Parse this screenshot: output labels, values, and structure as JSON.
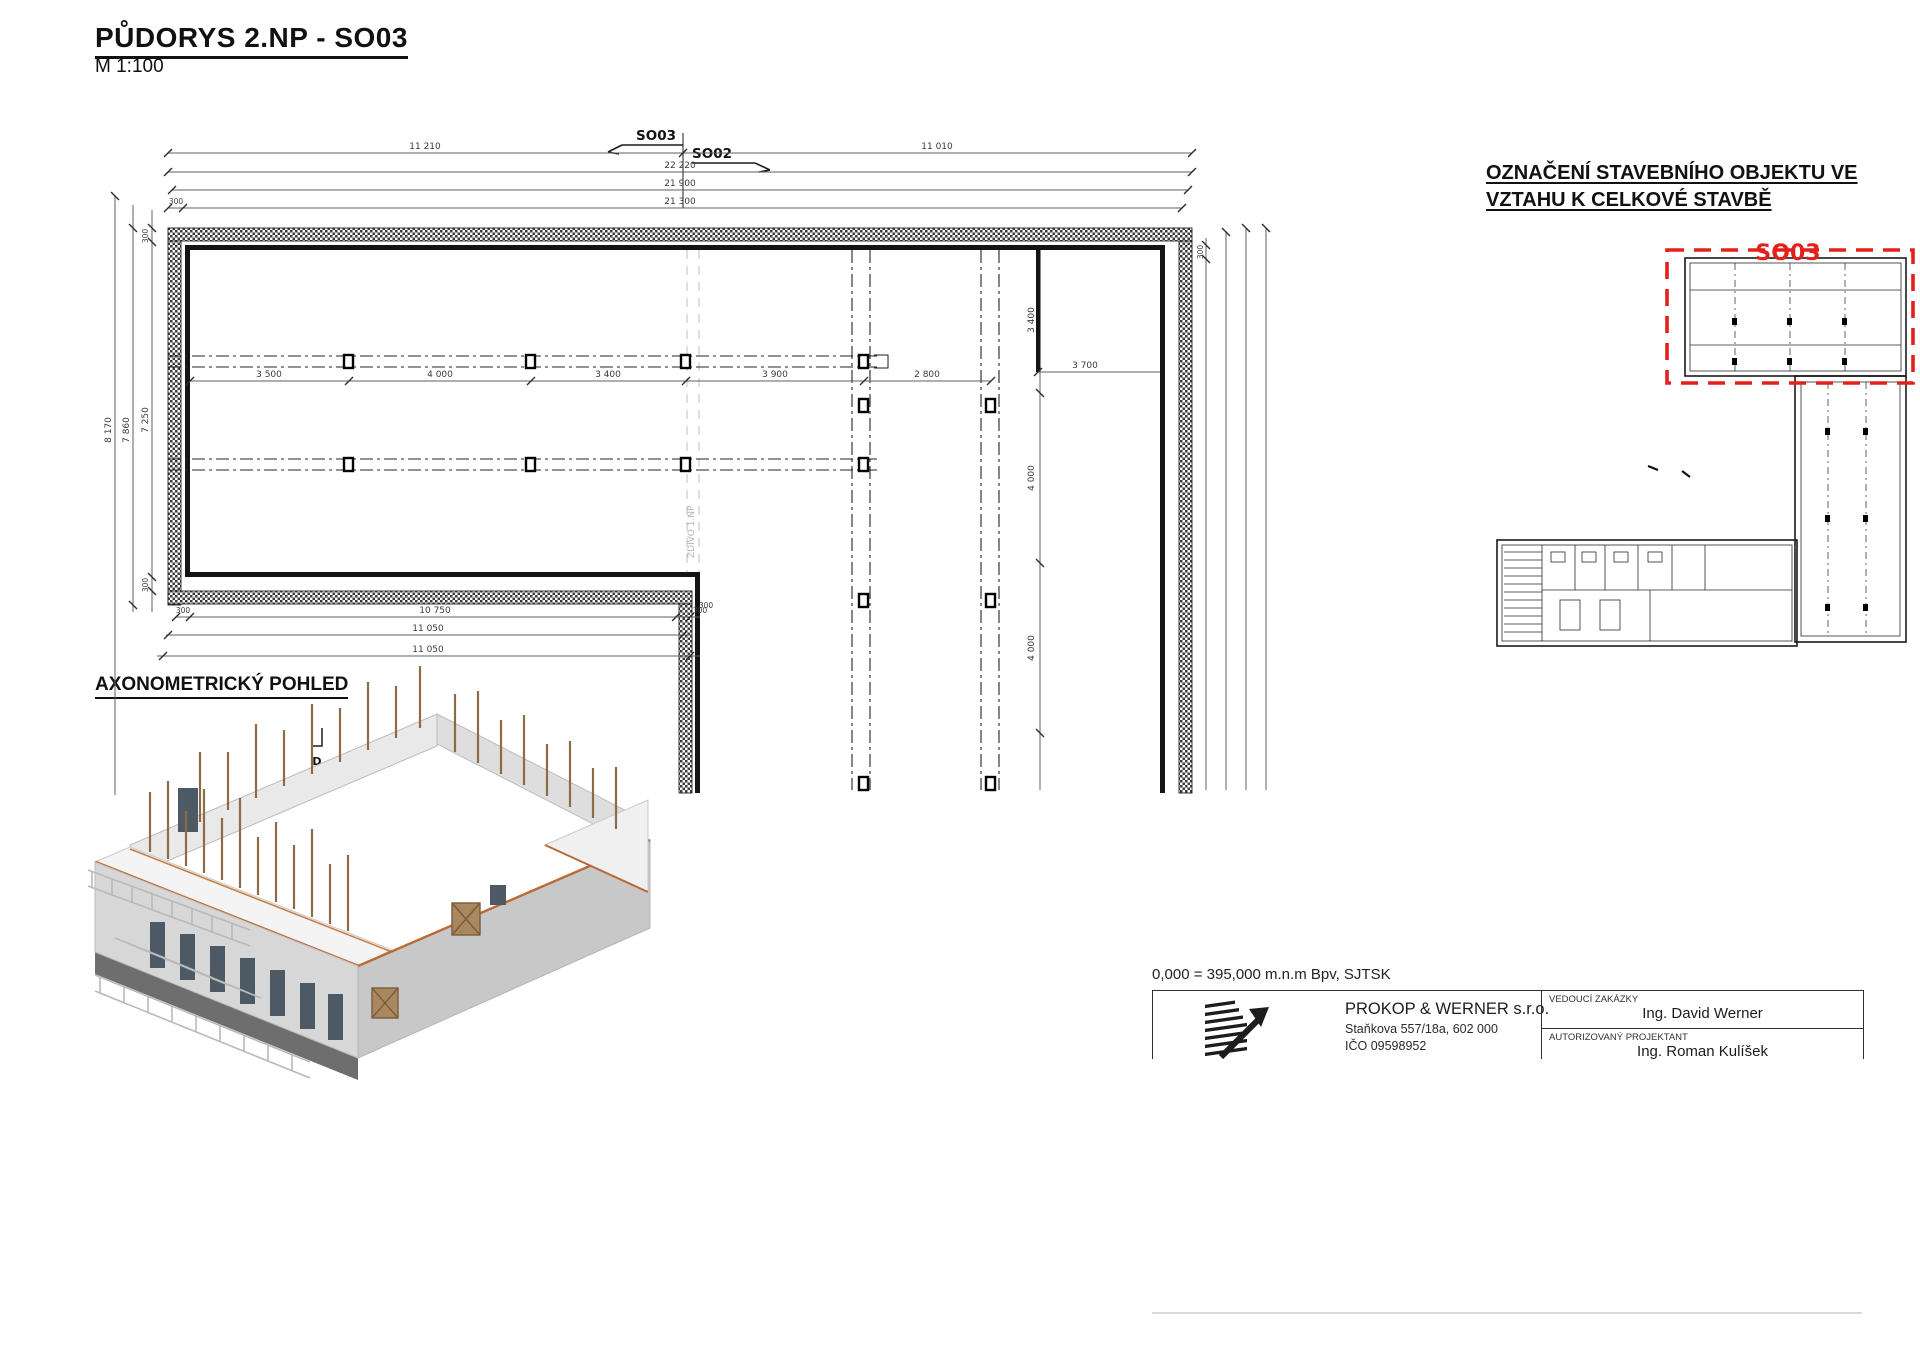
{
  "page_title": {
    "title": "PŮDORYS 2.NP - SO03",
    "scale": "M 1:100"
  },
  "colors": {
    "highlight_red": "#e3201b",
    "roof_accent": "#b96a35",
    "stud_brown": "#8d6b46"
  },
  "plan": {
    "object_labels": {
      "left": "SO03",
      "right": "SO02"
    },
    "note_ground_floor": "ZDIVO 1.NP",
    "section_mark": "D",
    "dims": {
      "top1_left": "11 210",
      "top1_right": "11 010",
      "top2": "22 220",
      "top3": "21 900",
      "top4_small": "300",
      "top4": "21 300",
      "left1": "8 170",
      "left2": "7 860",
      "left3_top": "300",
      "left3_mid": "7 250",
      "left3_bottom": "300",
      "chain": [
        "3 500",
        "4 000",
        "3 400",
        "3 900",
        "2 800",
        "3 700"
      ],
      "right_chain": [
        "3 400",
        "4 000",
        "4 000"
      ],
      "right_outer_small": "300",
      "corner_small": "300",
      "bottom1_left": "300",
      "bottom1": "10 750",
      "bottom1_right": "300",
      "bottom2": "11 050",
      "bottom3": "11 050"
    }
  },
  "site_plan": {
    "title_line1": "OZNAČENÍ STAVEBNÍHO OBJEKTU VE",
    "title_line2": "VZTAHU K CELKOVÉ STAVBĚ",
    "object_label": "SO03"
  },
  "axonometric": {
    "title": "AXONOMETRICKÝ POHLED"
  },
  "title_block": {
    "elevation_note": "0,000 = 395,000 m.n.m Bpv, SJTSK",
    "company_name": "PROKOP & WERNER s.r.o.",
    "company_address": "Staňkova 557/18a, 602 000",
    "company_id": "IČO 09598952",
    "lead_label": "VEDOUCÍ ZAKÁZKY",
    "lead_name": "Ing. David Werner",
    "authorized_label": "AUTORIZOVANÝ PROJEKTANT",
    "authorized_name": "Ing. Roman Kulíšek"
  }
}
